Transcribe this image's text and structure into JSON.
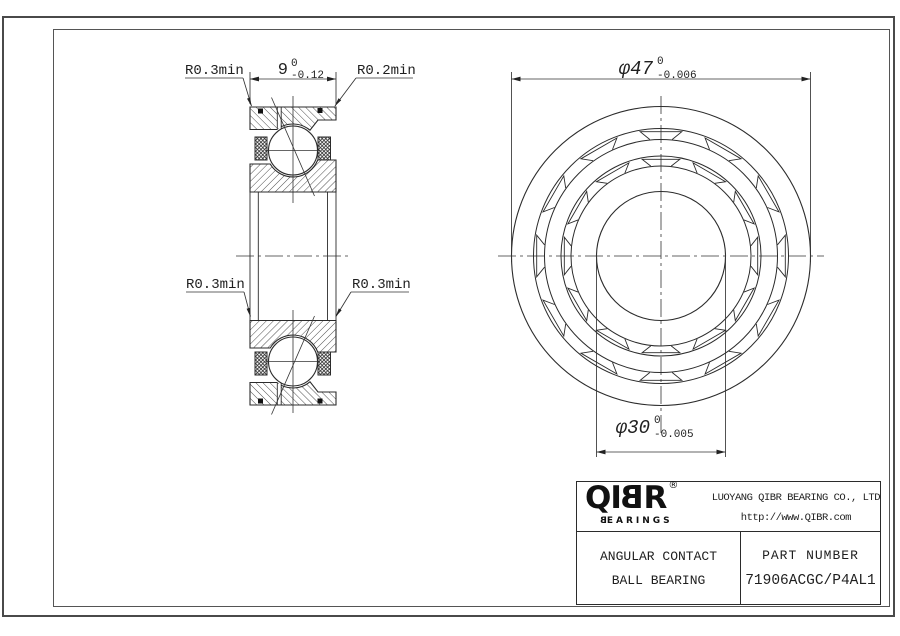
{
  "section_view": {
    "width_dim": {
      "value": "9",
      "tol_top": "0",
      "tol_bottom": "-0.12"
    },
    "callout_top_left": "R0.3min",
    "callout_top_right": "R0.2min",
    "callout_mid_left": "R0.3min",
    "callout_mid_right": "R0.3min"
  },
  "front_view": {
    "outer_dia": {
      "text": "φ47",
      "tol_top": "0",
      "tol_bottom": "-0.006"
    },
    "bore_dia": {
      "text": "φ30",
      "tol_top": "0",
      "tol_bottom": "-0.005"
    }
  },
  "title_block": {
    "logo": {
      "l0": "Q",
      "l1": "I",
      "l2": "B",
      "l3": "R",
      "registered": "®",
      "sub_first": "B",
      "sub_rest": "EARINGS"
    },
    "company_line1": "LUOYANG QIBR BEARING CO., LTD",
    "company_line2": "http://www.QIBR.com",
    "product_line1": "ANGULAR CONTACT",
    "product_line2": "BALL BEARING",
    "part_number_label": "PART NUMBER",
    "part_number": "71906ACGC/P4AL1"
  },
  "colors": {
    "line": "#2b2b2b",
    "frame": "#4a4a4a",
    "background": "#ffffff"
  }
}
